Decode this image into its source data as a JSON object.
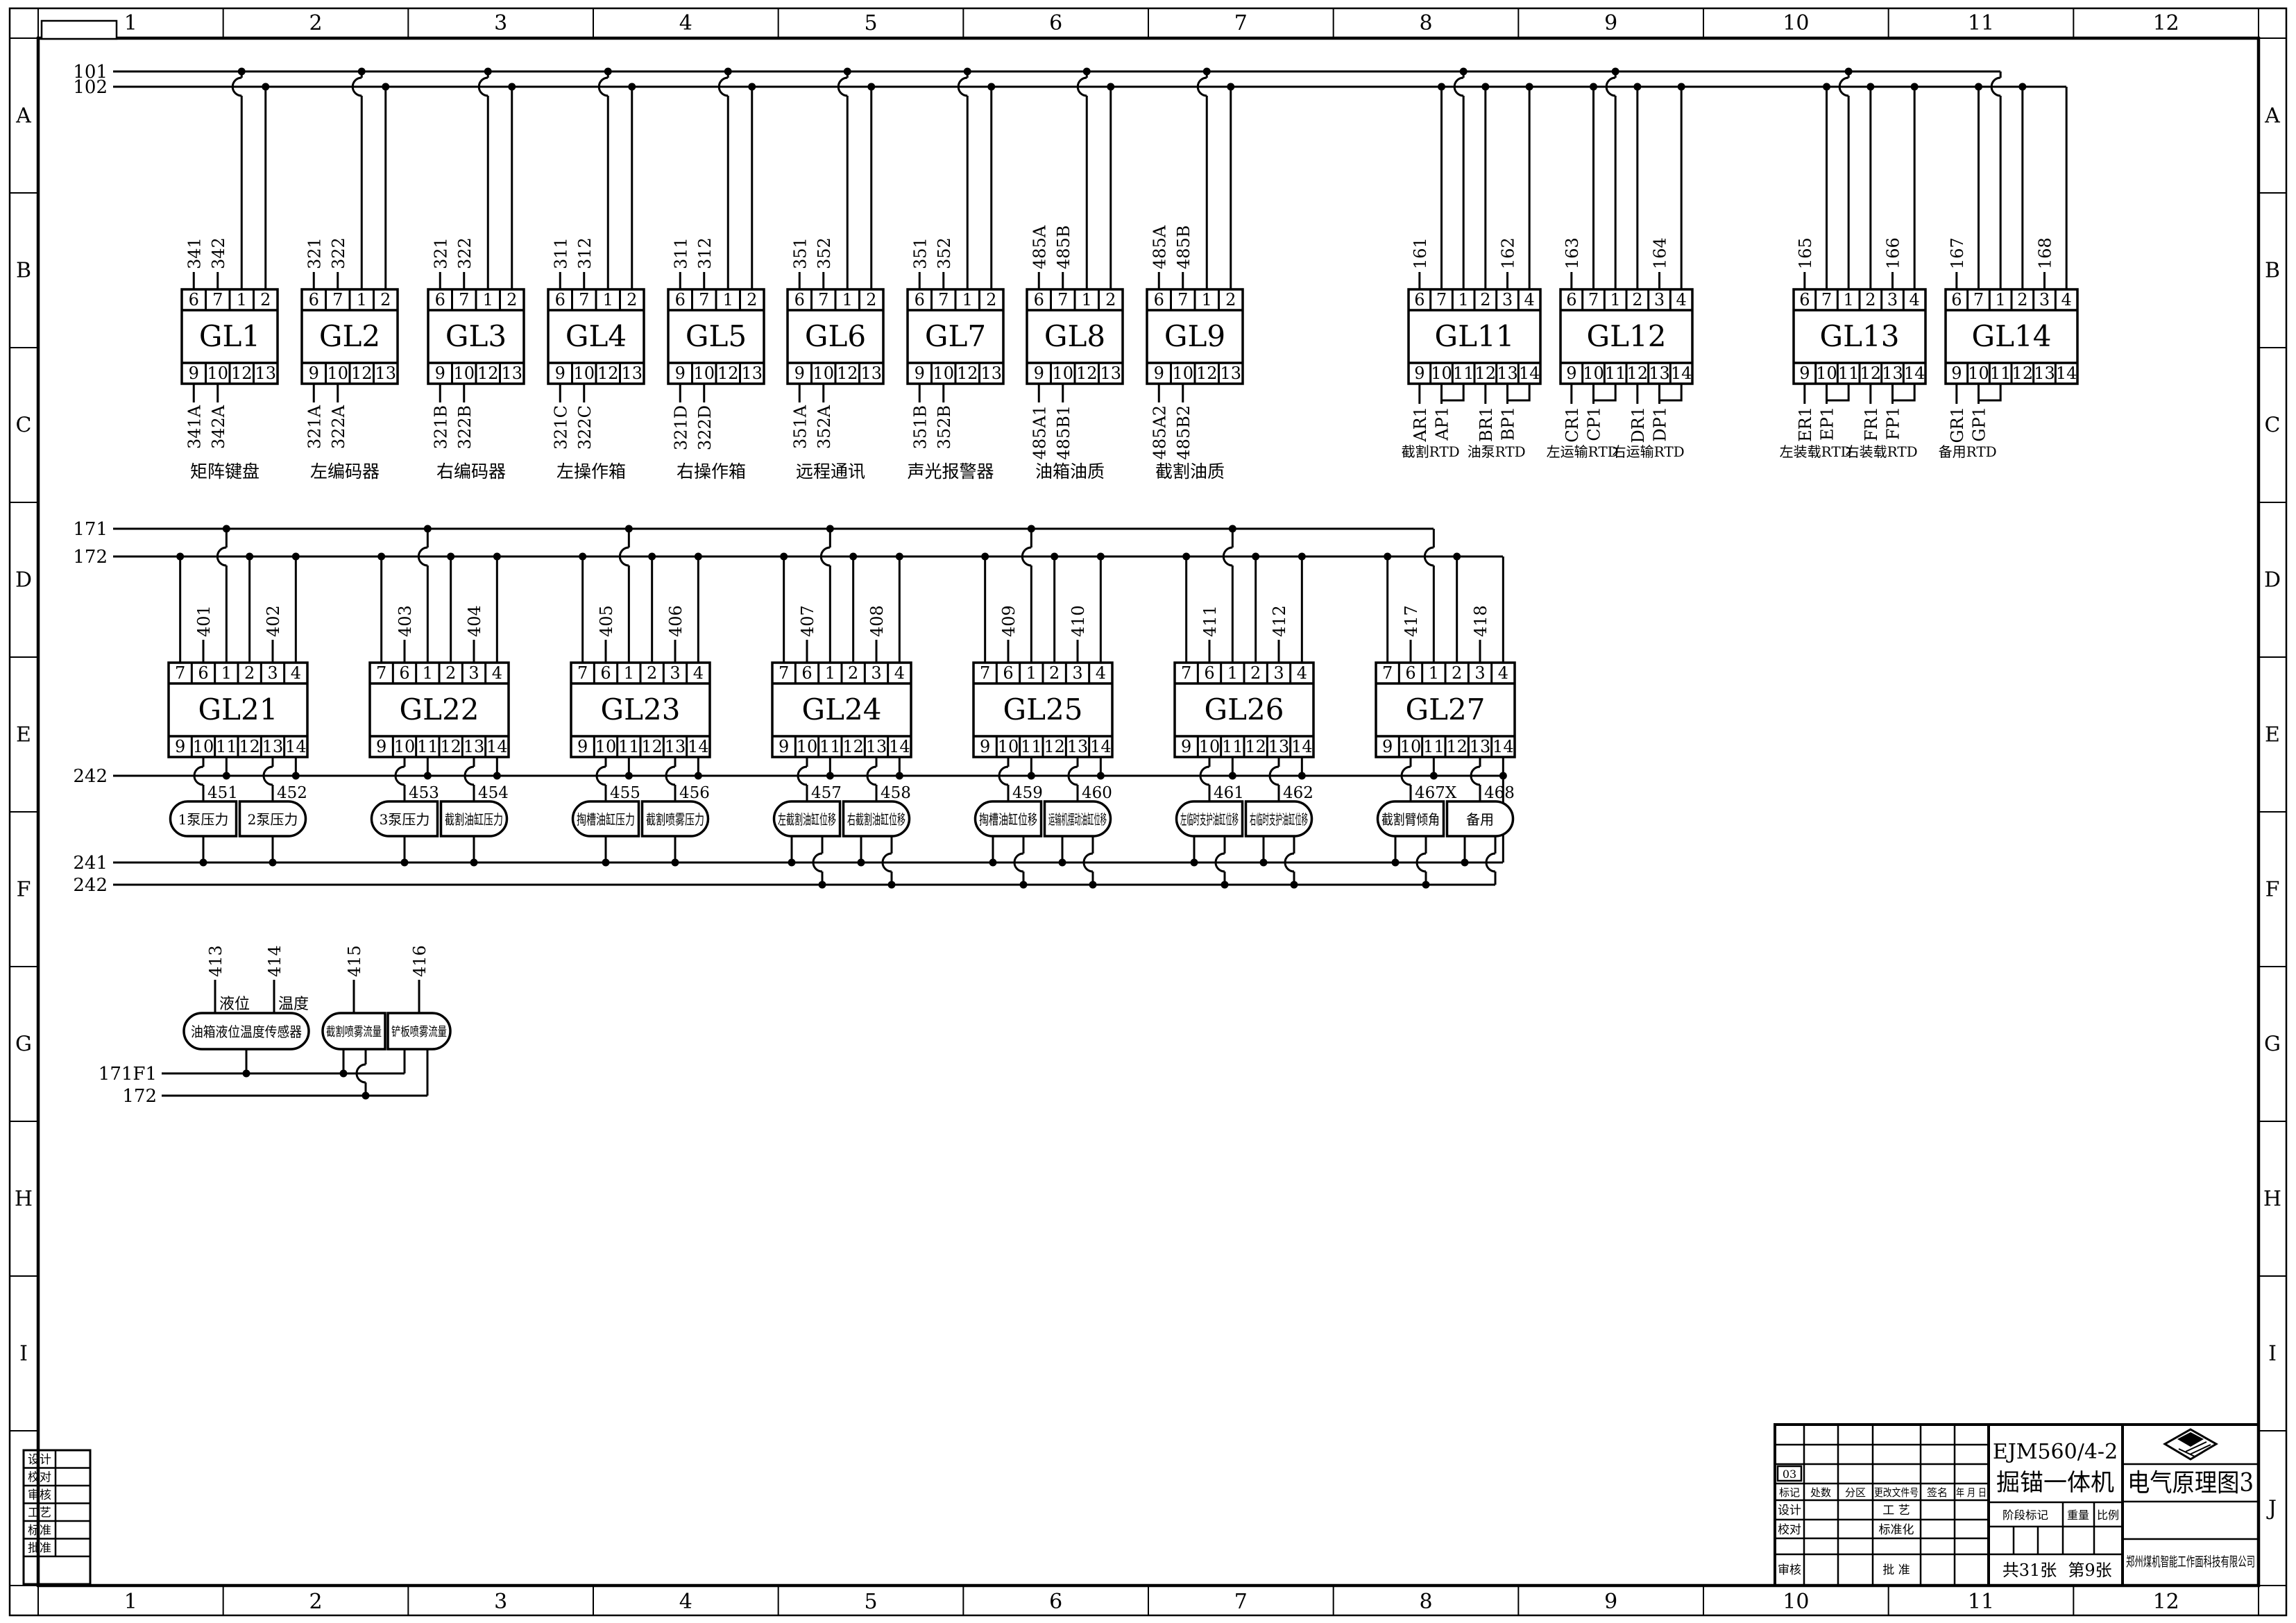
{
  "sheet": {
    "columns": [
      "1",
      "2",
      "3",
      "4",
      "5",
      "6",
      "7",
      "8",
      "9",
      "10",
      "11",
      "12"
    ],
    "rows": [
      "A",
      "B",
      "C",
      "D",
      "E",
      "F",
      "G",
      "H",
      "I",
      "J"
    ],
    "colors": {
      "ink": "#000000",
      "paper": "#ffffff"
    }
  },
  "power_buses_top": {
    "l1": "101",
    "l2": "102"
  },
  "io_terminals_top": [
    "6",
    "7",
    "1",
    "2"
  ],
  "io_terminals_bottom": [
    "9",
    "10",
    "12",
    "13"
  ],
  "io_modules": [
    {
      "name": "GL1",
      "top_wires": [
        "341",
        "342"
      ],
      "bottom_wires": [
        "341A",
        "342A"
      ],
      "label": "矩阵键盘"
    },
    {
      "name": "GL2",
      "top_wires": [
        "321",
        "322"
      ],
      "bottom_wires": [
        "321A",
        "322A"
      ],
      "label": "左编码器"
    },
    {
      "name": "GL3",
      "top_wires": [
        "321",
        "322"
      ],
      "bottom_wires": [
        "321B",
        "322B"
      ],
      "label": "右编码器"
    },
    {
      "name": "GL4",
      "top_wires": [
        "311",
        "312"
      ],
      "bottom_wires": [
        "321C",
        "322C"
      ],
      "label": "左操作箱"
    },
    {
      "name": "GL5",
      "top_wires": [
        "311",
        "312"
      ],
      "bottom_wires": [
        "321D",
        "322D"
      ],
      "label": "右操作箱"
    },
    {
      "name": "GL6",
      "top_wires": [
        "351",
        "352"
      ],
      "bottom_wires": [
        "351A",
        "352A"
      ],
      "label": "远程通讯"
    },
    {
      "name": "GL7",
      "top_wires": [
        "351",
        "352"
      ],
      "bottom_wires": [
        "351B",
        "352B"
      ],
      "label": "声光报警器"
    },
    {
      "name": "GL8",
      "top_wires": [
        "485A",
        "485B"
      ],
      "bottom_wires": [
        "485A1",
        "485B1"
      ],
      "label": "油箱油质"
    },
    {
      "name": "GL9",
      "top_wires": [
        "485A",
        "485B"
      ],
      "bottom_wires": [
        "485A2",
        "485B2"
      ],
      "label": "截割油质"
    }
  ],
  "rtd_terminals_top": [
    "6",
    "7",
    "1",
    "2",
    "3",
    "4"
  ],
  "rtd_terminals_bottom": [
    "9",
    "10",
    "11",
    "12",
    "13",
    "14"
  ],
  "rtd_modules": [
    {
      "name": "GL11",
      "wire_a": "161",
      "wire_b": "162",
      "bottom_wires": [
        "AR1",
        "AP1",
        "BR1",
        "BP1"
      ],
      "labels": [
        "截割RTD",
        "油泵RTD"
      ]
    },
    {
      "name": "GL12",
      "wire_a": "163",
      "wire_b": "164",
      "bottom_wires": [
        "CR1",
        "CP1",
        "DR1",
        "DP1"
      ],
      "labels": [
        "左运输RTD",
        "右运输RTD"
      ]
    },
    {
      "name": "GL13",
      "wire_a": "165",
      "wire_b": "166",
      "bottom_wires": [
        "ER1",
        "EP1",
        "FR1",
        "FP1"
      ],
      "labels": [
        "左装载RTD",
        "右装载RTD"
      ]
    },
    {
      "name": "GL14",
      "wire_a": "167",
      "wire_b": "168",
      "bottom_wires": [
        "GR1",
        "GP1"
      ],
      "labels": [
        "备用RTD"
      ]
    }
  ],
  "analog_buses": {
    "l1": "171",
    "l2": "172",
    "l3": "242",
    "l4": "241",
    "l5": "242"
  },
  "analog_terminals_top": [
    "7",
    "6",
    "1",
    "2",
    "3",
    "4"
  ],
  "analog_terminals_bottom": [
    "9",
    "10",
    "11",
    "12",
    "13",
    "14"
  ],
  "analog_modules": [
    {
      "name": "GL21",
      "wire_a": "401",
      "wire_b": "402",
      "sensor_a": {
        "wire": "451",
        "label": "1泵压力",
        "pins": 1
      },
      "sensor_b": {
        "wire": "452",
        "label": "2泵压力",
        "pins": 1
      }
    },
    {
      "name": "GL22",
      "wire_a": "403",
      "wire_b": "404",
      "sensor_a": {
        "wire": "453",
        "label": "3泵压力",
        "pins": 1
      },
      "sensor_b": {
        "wire": "454",
        "label": "截割油缸压力",
        "pins": 1
      }
    },
    {
      "name": "GL23",
      "wire_a": "405",
      "wire_b": "406",
      "sensor_a": {
        "wire": "455",
        "label": "掏槽油缸压力",
        "pins": 1
      },
      "sensor_b": {
        "wire": "456",
        "label": "截割喷雾压力",
        "pins": 1
      }
    },
    {
      "name": "GL24",
      "wire_a": "407",
      "wire_b": "408",
      "sensor_a": {
        "wire": "457",
        "label": "左截割油缸位移",
        "pins": 2
      },
      "sensor_b": {
        "wire": "458",
        "label": "右截割油缸位移",
        "pins": 2
      }
    },
    {
      "name": "GL25",
      "wire_a": "409",
      "wire_b": "410",
      "sensor_a": {
        "wire": "459",
        "label": "掏槽油缸位移",
        "pins": 2
      },
      "sensor_b": {
        "wire": "460",
        "label": "运输机摆动油缸位移",
        "pins": 2
      }
    },
    {
      "name": "GL26",
      "wire_a": "411",
      "wire_b": "412",
      "sensor_a": {
        "wire": "461",
        "label": "左临时支护油缸位移",
        "pins": 2
      },
      "sensor_b": {
        "wire": "462",
        "label": "右临时支护油缸位移",
        "pins": 2
      }
    },
    {
      "name": "GL27",
      "wire_a": "417",
      "wire_b": "418",
      "sensor_a": {
        "wire": "467X",
        "label": "截割臂倾角",
        "pins": 2
      },
      "sensor_b": {
        "wire": "468",
        "label": "备用",
        "pins": 2
      }
    }
  ],
  "flow_section": {
    "bus1": "171F1",
    "bus2": "172",
    "tank": {
      "label": "油箱液位温度传感器",
      "wires": [
        {
          "num": "413",
          "tag": "液位"
        },
        {
          "num": "414",
          "tag": "温度"
        }
      ]
    },
    "flow_sensors": [
      {
        "num": "415",
        "label": "截割喷雾流量"
      },
      {
        "num": "416",
        "label": "铲板喷雾流量"
      }
    ]
  },
  "approval_strip": [
    "设计",
    "校对",
    "审核",
    "工艺",
    "标准",
    "批准"
  ],
  "title_block": {
    "rev_code": "03",
    "header_cells": [
      "标记",
      "处数",
      "分区",
      "更改文件号",
      "签名",
      "年 月 日"
    ],
    "row_design": "设计",
    "row_craft": "工 艺",
    "row_check": "校对",
    "row_std": "标准化",
    "row_audit": "审核",
    "row_approve": "批 准",
    "product_model": "EJM560/4-2",
    "product_name": "掘锚一体机",
    "stage_label": "阶段标记",
    "weight_label": "重量",
    "scale_label": "比例",
    "sheet_total": "共31张",
    "sheet_no": "第9张",
    "drawing_title": "电气原理图3",
    "company": "郑州煤机智能工作面科技有限公司"
  }
}
